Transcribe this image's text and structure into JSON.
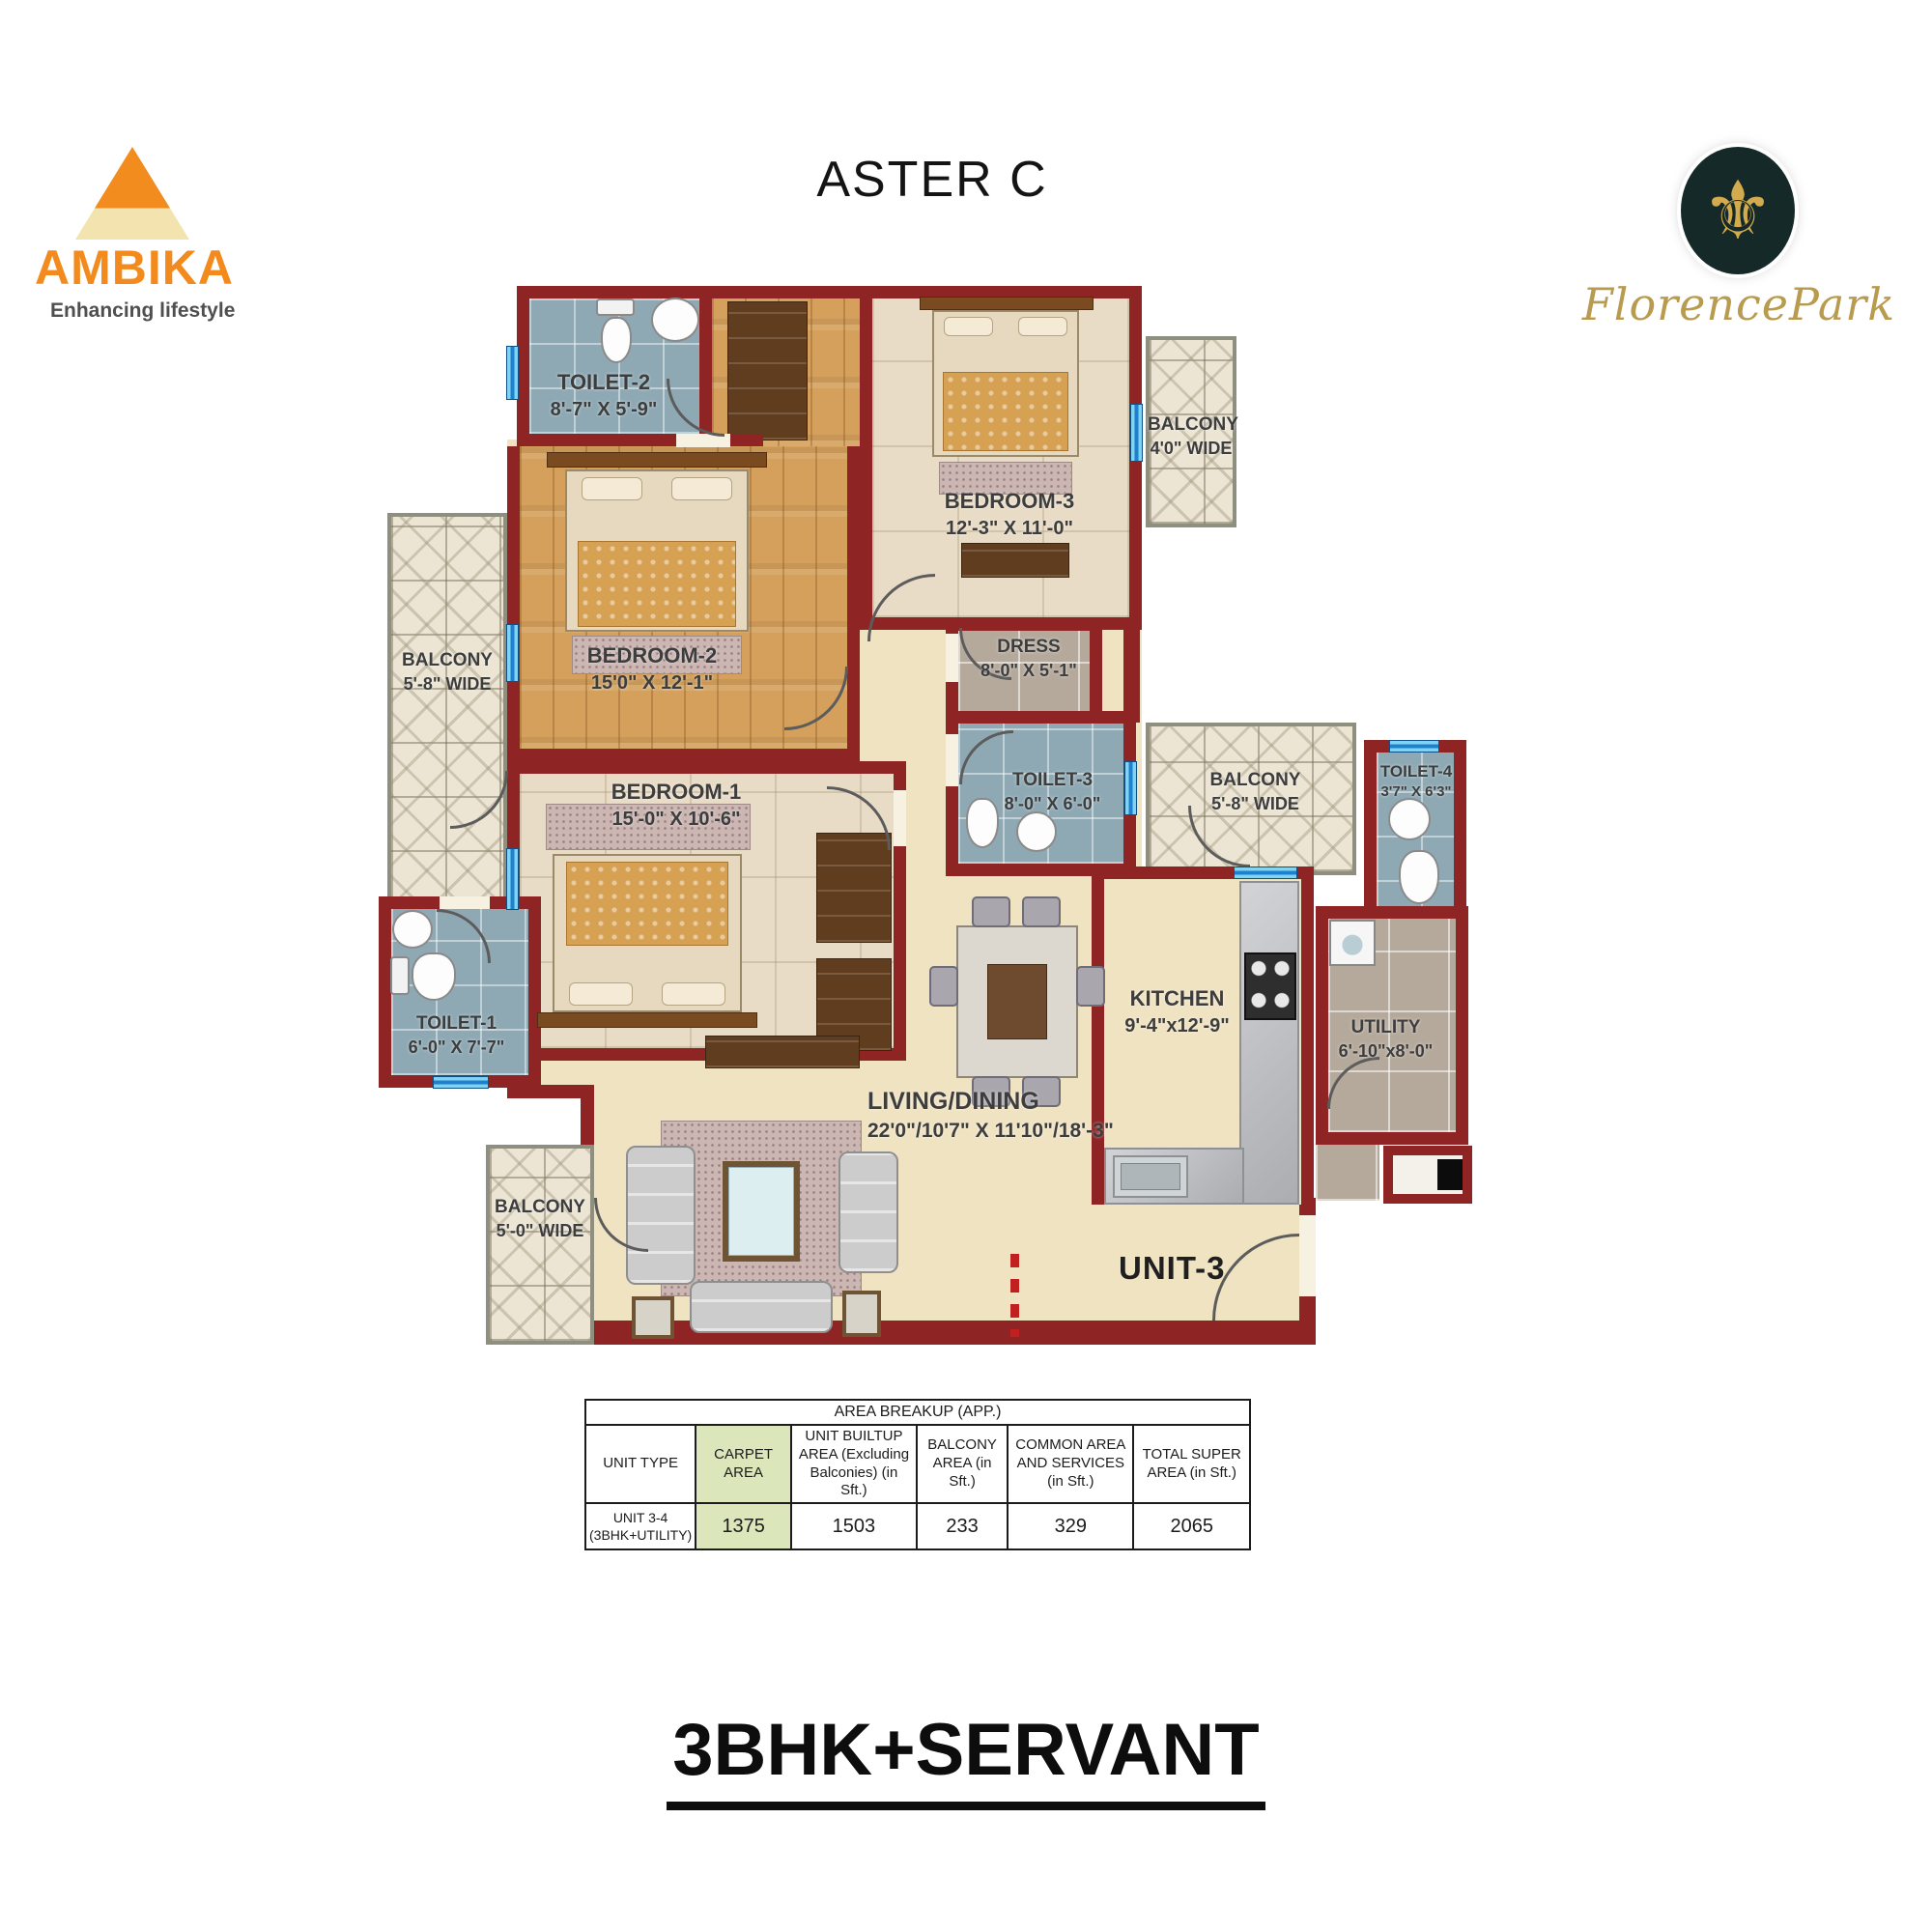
{
  "header": {
    "ambika": {
      "name": "AMBIKA",
      "tagline": "Enhancing lifestyle"
    },
    "plan_title": "ASTER C",
    "florence": {
      "name": "FlorencePark"
    }
  },
  "floorplan": {
    "unit_label": "UNIT-3",
    "rooms": [
      {
        "id": "toilet-2",
        "name": "TOILET-2",
        "dims": "8'-7\" X 5'-9\""
      },
      {
        "id": "bedroom-3",
        "name": "BEDROOM-3",
        "dims": "12'-3\" X 11'-0\""
      },
      {
        "id": "balcony-top-right",
        "name": "BALCONY",
        "dims": "4'0\" WIDE"
      },
      {
        "id": "bedroom-2",
        "name": "BEDROOM-2",
        "dims": "15'0\" X 12'-1\""
      },
      {
        "id": "balcony-left",
        "name": "BALCONY",
        "dims": "5'-8\" WIDE"
      },
      {
        "id": "bedroom-1",
        "name": "BEDROOM-1",
        "dims": "15'-0\" X 10'-6\""
      },
      {
        "id": "dress",
        "name": "DRESS",
        "dims": "8'-0\" X 5'-1\""
      },
      {
        "id": "toilet-3",
        "name": "TOILET-3",
        "dims": "8'-0\" X 6'-0\""
      },
      {
        "id": "balcony-mid-right",
        "name": "BALCONY",
        "dims": "5'-8\" WIDE"
      },
      {
        "id": "toilet-4",
        "name": "TOILET-4",
        "dims": "3'7\" X 6'3\""
      },
      {
        "id": "kitchen",
        "name": "KITCHEN",
        "dims": "9'-4\"x12'-9\""
      },
      {
        "id": "utility",
        "name": "UTILITY",
        "dims": "6'-10\"x8'-0\""
      },
      {
        "id": "living-dining",
        "name": "LIVING/DINING",
        "dims": "22'0\"/10'7\" X 11'10\"/18'-3\""
      },
      {
        "id": "toilet-1",
        "name": "TOILET-1",
        "dims": "6'-0\" X 7'-7\""
      },
      {
        "id": "balcony-bottom",
        "name": "BALCONY",
        "dims": "5'-0\" WIDE"
      }
    ]
  },
  "area_table": {
    "title": "AREA BREAKUP (APP.)",
    "headers": [
      "UNIT TYPE",
      "CARPET AREA",
      "UNIT BUILTUP AREA (Excluding Balconies) (in Sft.)",
      "BALCONY AREA (in Sft.)",
      "COMMON AREA AND SERVICES (in Sft.)",
      "TOTAL SUPER AREA (in Sft.)"
    ],
    "row": {
      "unit_type": "UNIT 3-4 (3BHK+UTILITY)",
      "carpet_area": "1375",
      "builtup_area": "1503",
      "balcony_area": "233",
      "common_area": "329",
      "total_super_area": "2065"
    }
  },
  "footer_title": "3BHK+SERVANT",
  "colors": {
    "wall": "#8e2424",
    "accent_orange": "#f28a1e",
    "gold": "#b89b4e",
    "carpet_highlight": "#dbe6bb",
    "toilet_tile": "#8ea9b4",
    "floor_cream": "#f0e3c2"
  }
}
